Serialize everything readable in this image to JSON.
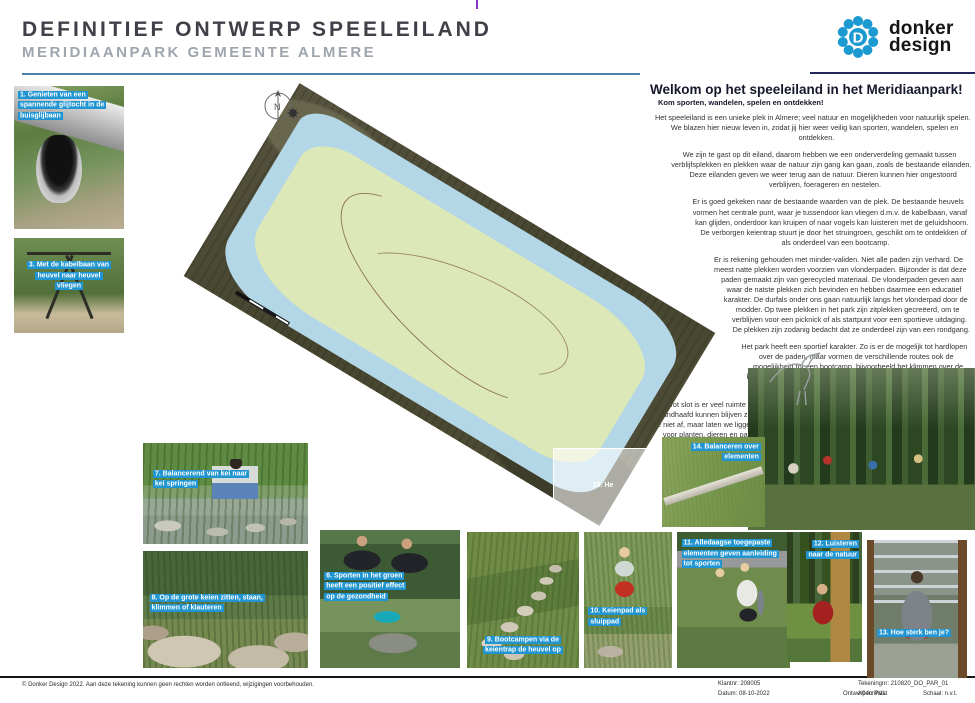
{
  "header": {
    "title": "DEFINITIEF ONTWERP SPEELEILAND",
    "subtitle": "MERIDIAANPARK GEMEENTE ALMERE"
  },
  "logo": {
    "monogram": "D",
    "company_line1": "donker",
    "company_line2": "design"
  },
  "welcome": {
    "heading": "Welkom op het speeleiland in het Meridiaanpark!",
    "subheading": "Kom sporten, wandelen, spelen en ontdekken!",
    "paragraphs": [
      "Het speeleiland is een unieke plek in Almere; veel natuur en mogelijkheden voor natuurlijk spelen. We blazen hier nieuw leven in, zodat jij hier weer veilig kan sporten, wandelen, spelen en ontdekken.",
      "We zijn te gast op dit eiland, daarom hebben we een onderverdeling gemaakt tussen verblijfsplekken en plekken waar de natuur zijn gang kan gaan, zoals de bestaande eilanden. Deze eilanden geven we weer terug aan de natuur. Dieren kunnen hier ongestoord verblijven, foerageren en nestelen.",
      "Er is goed gekeken naar de bestaande waarden van de plek. De bestaande heuvels vormen het centrale punt, waar je tussendoor kan vliegen d.m.v. de kabelbaan, vanaf kan glijden, onderdoor kan kruipen of naar vogels kan luisteren met de geluidshoorn. De verborgen keientrap stuurt je door het struingroen, geschikt om te ontdekken of als onderdeel van een bootcamp.",
      "Er is rekening gehouden met minder-validen. Niet alle paden zijn verhard. De meest natte plekken worden voorzien van vlonderpaden. Bijzonder is dat deze paden gemaakt zijn van gerecycled materiaal. De vlonderpaden geven aan waar de natste plekken zich bevinden en hebben daarmee een educatief karakter. De durfals onder ons gaan natuurlijk langs het vlonderpad door de modder. Op twee plekken in het park zijn zitplekken gecreëerd, om te verblijven voor een picknick of als startpunt voor een sportieve uitdaging. De plekken zijn zodanig bedacht dat ze onderdeel zijn van een rondgang.",
      "Het park heeft een sportief karakter. Zo is er de mogelijk tot hardlopen over de paden, maar vormen de verschillende routes ook de mogelijkheid tot een bootcamp, bijvoorbeeld het klimmen over de klimrots, klauteren over de keientrap of rek- en strekoefeningen bij de fietsnietjes.",
      "Tot slot is er veel ruimte voor duurzaamheid, circulariteit en biodiversiteit. Elementen die gehandhaafd kunnen blijven zijn geïntegreerd in het ontwerp. Groen wat weggehaald wordt, voeren we niet af, maar laten we liggen op het eiland. Dode boomstammen zijn een bron van biodiversiteit voor planten, dieren en paddenstoelen die het als voedselbron of woonplaats gebruiken. De klimmuur is gemaakt van restmateriaal van stenen."
    ]
  },
  "map": {
    "compass_label": "N"
  },
  "photos": [
    {
      "label": "1. Genieten van een spannende glijtocht in de buisglijbaan"
    },
    {
      "label": "3. Met de kabelbaan van heuvel naar heuvel vliegen"
    },
    {
      "label": "6. Sporten in het groen heeft een positief effect op de gezondheid"
    },
    {
      "label": "7. Balancerend van kei naar kei springen"
    },
    {
      "label": "8. Op de grote keien zitten, staan, klimmen of klauteren"
    },
    {
      "label": "9. Bootcampen via de keientrap de heuvel op"
    },
    {
      "label": "10. Keienpad als sluippad"
    },
    {
      "label": "11. Alledaagse toegepaste elementen geven aanleiding tot sporten"
    },
    {
      "label": "12. Luisteren naar de natuur"
    },
    {
      "label": "13. Hoe sterk ben je?"
    },
    {
      "label": "14. Balanceren over elementen"
    },
    {
      "label": "15. He"
    }
  ],
  "footer": {
    "copyright": "© Donker Design 2022. Aan deze tekening kunnen geen rechten worden ontleend, wijzigingen voorbehouden.",
    "client": "Klantnr: 208005",
    "date": "Datum: 08-10-2022",
    "designer": "Ontwerper: PVL",
    "drawing_no": "Tekeningnr: 210820_DO_PAR_01",
    "format": "A0 formaat",
    "scale": "Schaal: n.v.t."
  },
  "colors": {
    "caption_highlight": "#2095d2",
    "rule_blue": "#4d7fae",
    "rule_navy": "#23255c",
    "logo_blue": "#1b9ad2"
  }
}
